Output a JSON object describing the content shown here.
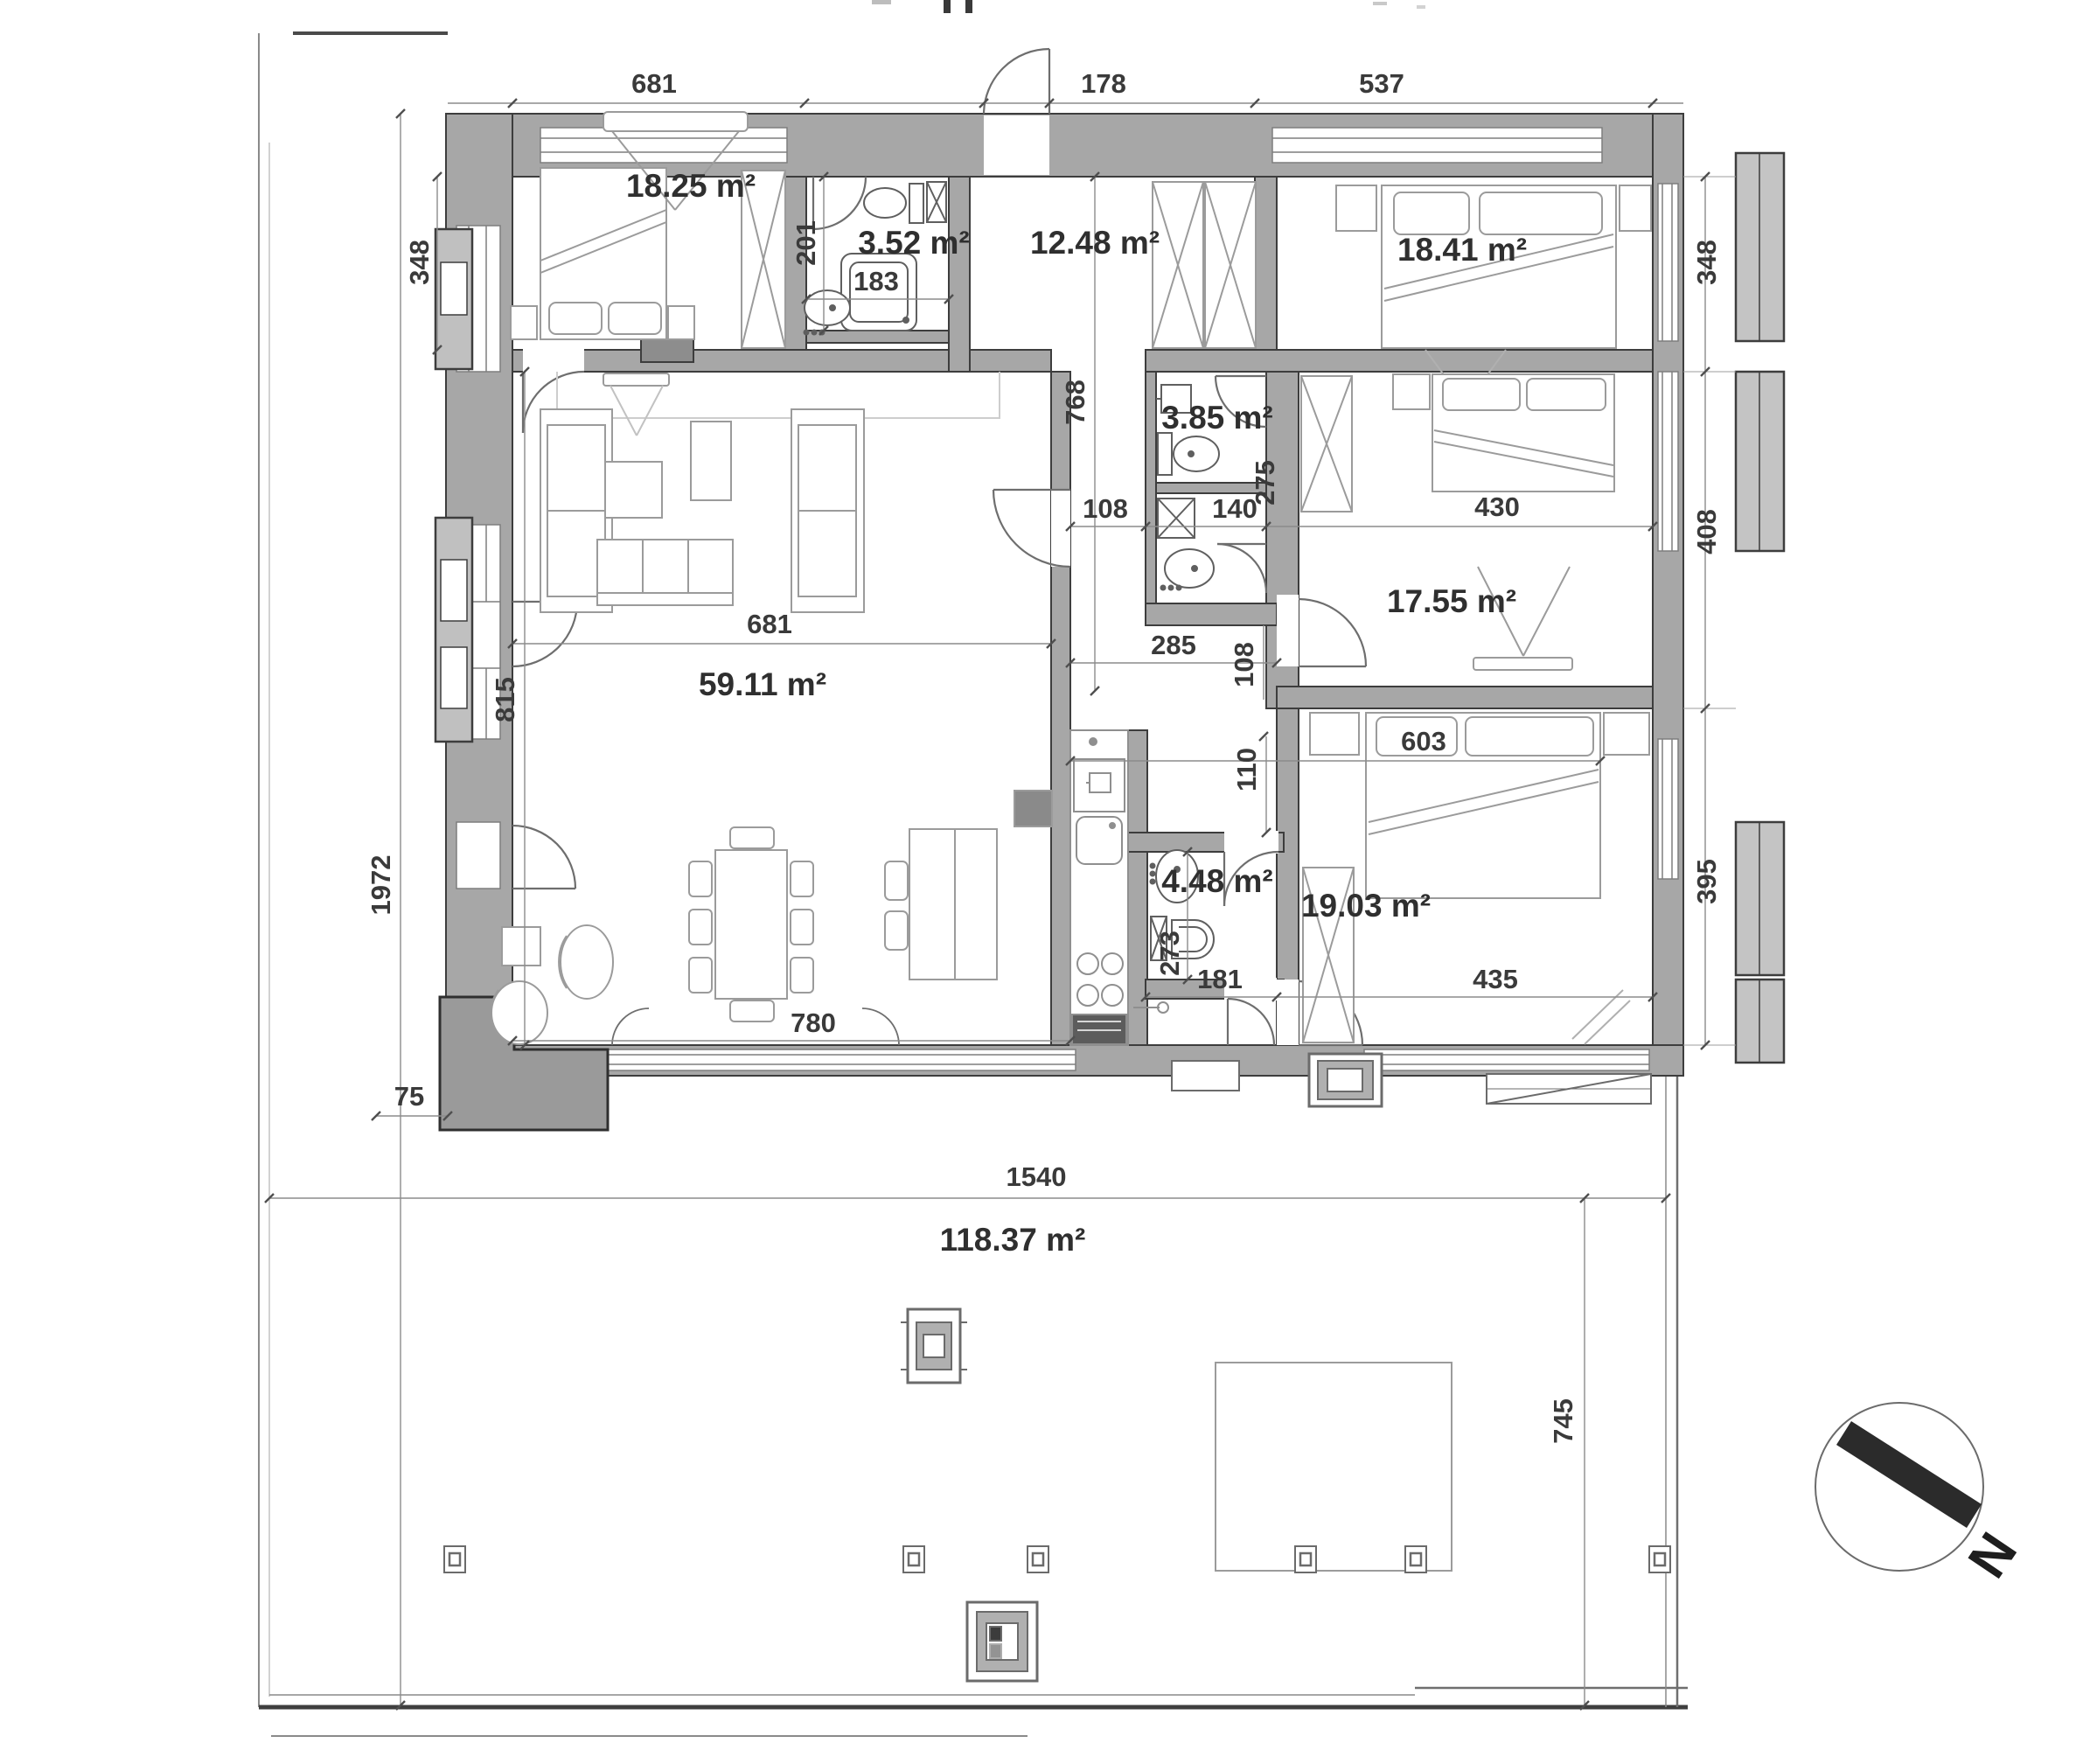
{
  "plan": {
    "areas": {
      "bedroom_top_left": "18.25 m²",
      "bathroom_top": "3.52 m²",
      "hallway": "12.48 m²",
      "bedroom_top_right": "18.41 m²",
      "bathroom_middle": "3.85 m²",
      "bedroom_middle_right": "17.55 m²",
      "living_kitchen": "59.11 m²",
      "bathroom_lower": "4.48 m²",
      "bedroom_bottom_right": "19.03 m²",
      "terrace": "118.37 m²"
    },
    "dimensions": {
      "w_bedroom_top_left": "681",
      "w_entrance": "178",
      "w_bedroom_top_right": "537",
      "h_bedroom_top_left": "348",
      "h_bedroom_top_right": "348",
      "h_bathroom_top": "201",
      "w_bathroom_top": "183",
      "h_hallway": "768",
      "h_bathroom_middle": "275",
      "w_bathroom_middle": "140",
      "w_corridor": "108",
      "w_bedroom_middle_right": "430",
      "h_bedroom_middle_right": "408",
      "w_living": "681",
      "h_living": "815",
      "w_hall_lower": "285",
      "h_corridor_small": "108",
      "h_hall_junction": "110",
      "w_bedroom_bottom_inner": "603",
      "h_bathroom_lower": "273",
      "w_hall_bottom": "181",
      "w_bedroom_bottom_right": "435",
      "h_bedroom_bottom_right": "395",
      "w_living_bottom": "780",
      "w_side_strip": "75",
      "h_total": "1972",
      "w_terrace": "1540",
      "h_terrace": "745"
    },
    "compass": {
      "north_label": "N"
    }
  }
}
